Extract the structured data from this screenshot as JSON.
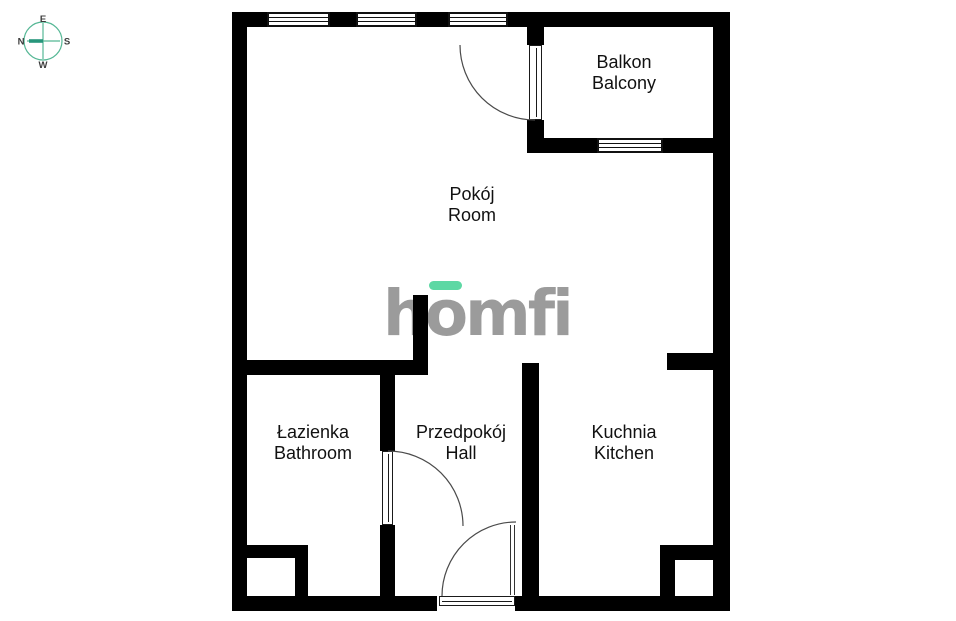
{
  "compass": {
    "top": "E",
    "left": "N",
    "right": "S",
    "bottom": "W"
  },
  "logo": {
    "text": "homfi",
    "text_color": "#9B9B9B",
    "accent_color": "#5DD8A4"
  },
  "rooms": [
    {
      "name_pl": "Balkon",
      "name_en": "Balcony"
    },
    {
      "name_pl": "Pokój",
      "name_en": "Room"
    },
    {
      "name_pl": "Łazienka",
      "name_en": "Bathroom"
    },
    {
      "name_pl": "Przedpokój",
      "name_en": "Hall"
    },
    {
      "name_pl": "Kuchnia",
      "name_en": "Kitchen"
    }
  ],
  "colors": {
    "wall": "#000000",
    "background": "#FFFFFF",
    "door_arc": "#4A4A4A",
    "label": "#111111",
    "compass_ring": "#55B795",
    "compass_needle": "#27967B"
  }
}
